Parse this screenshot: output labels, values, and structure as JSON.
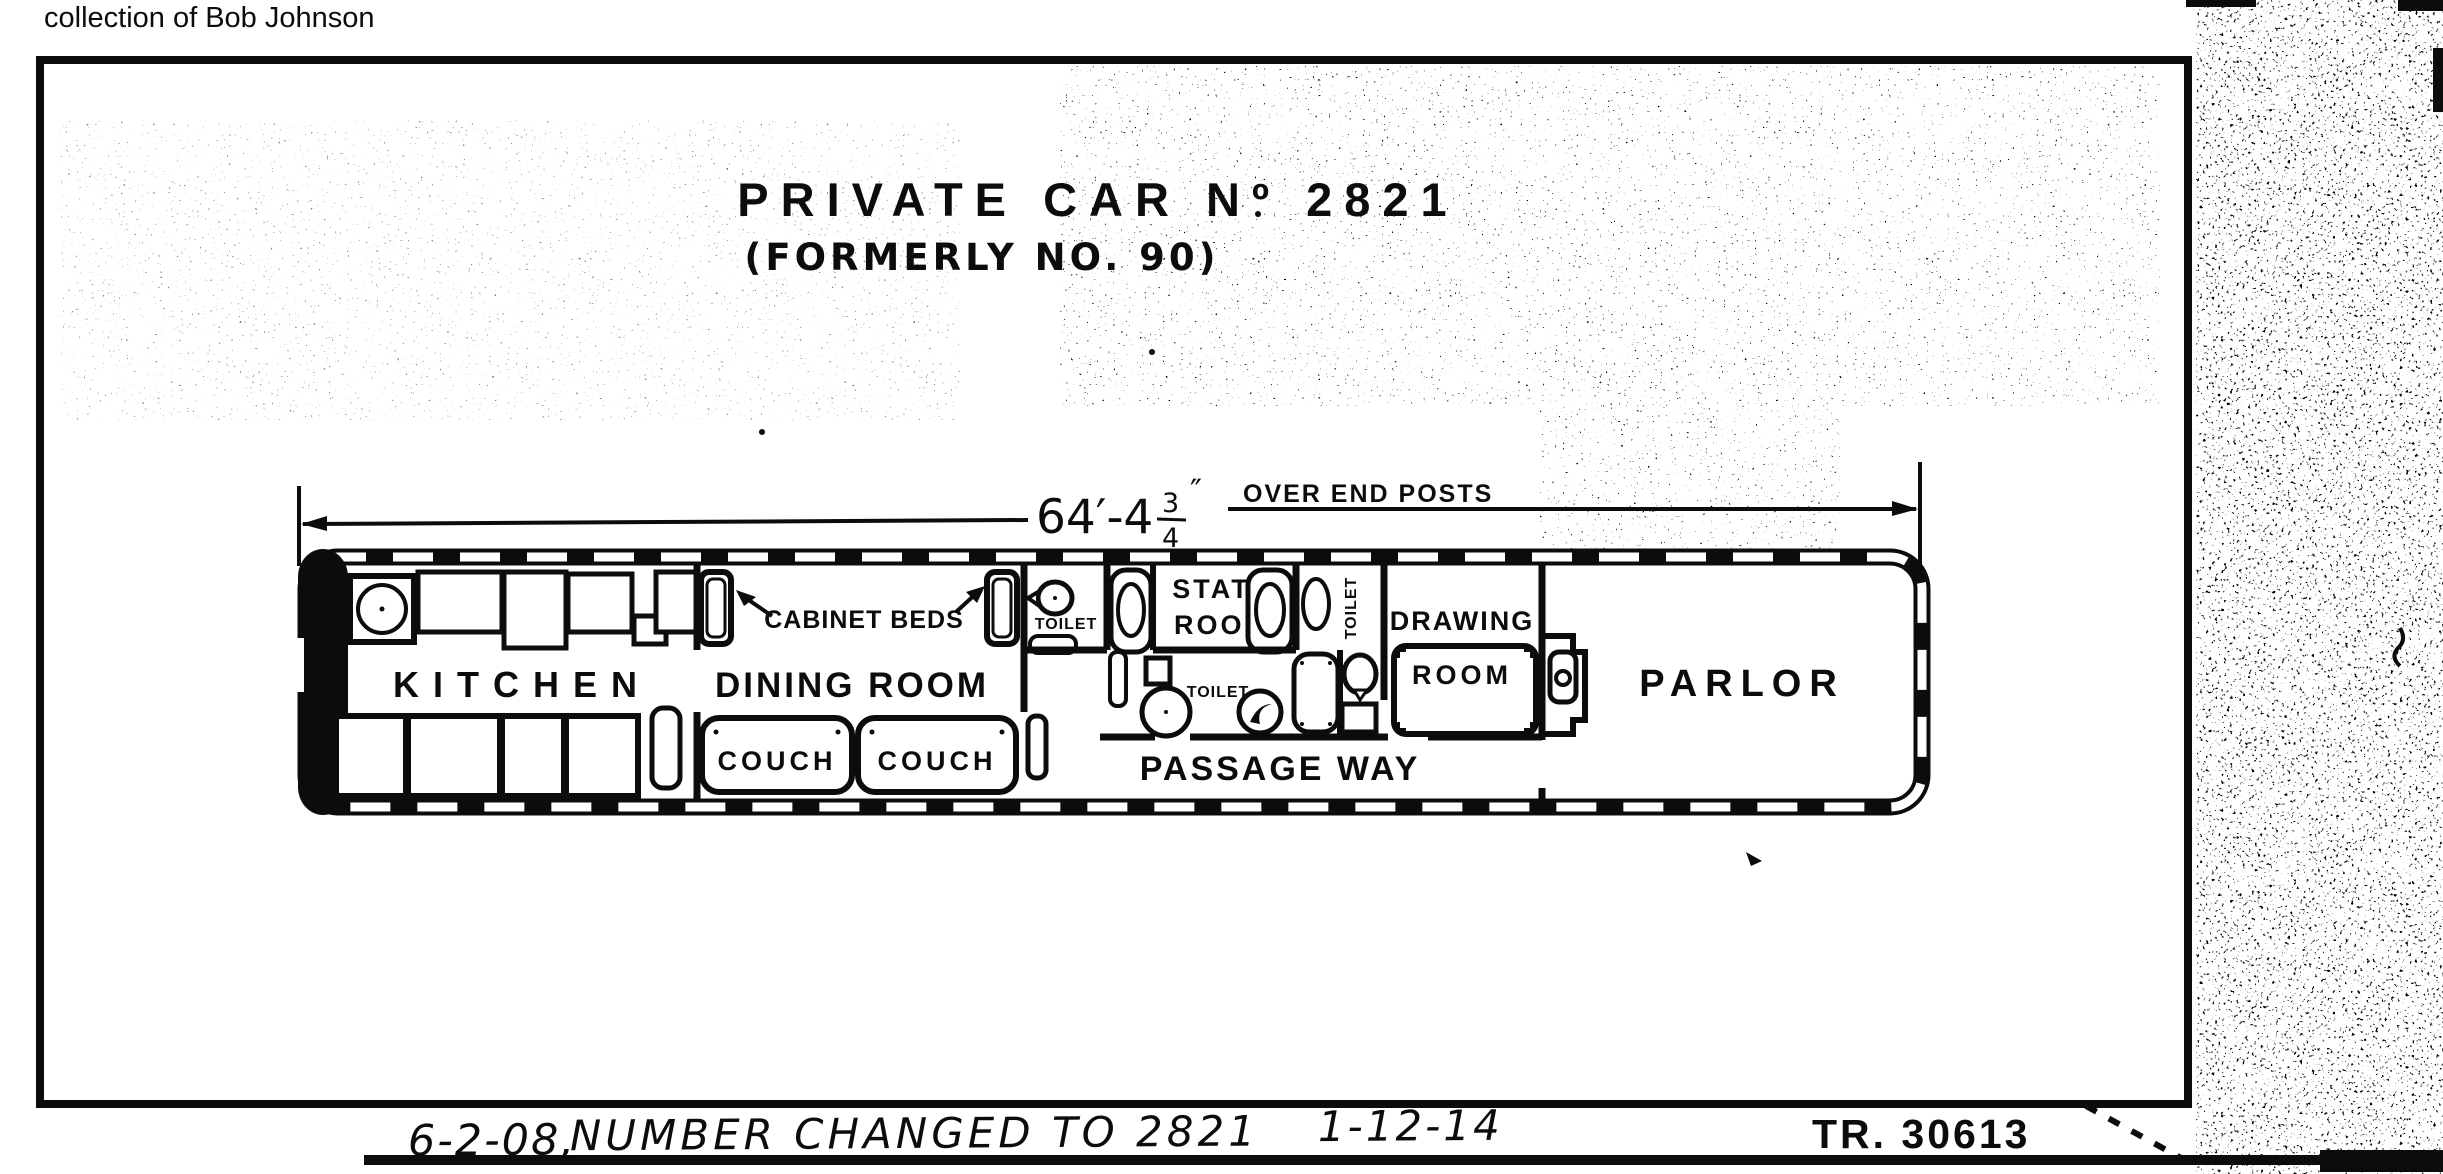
{
  "scan": {
    "collection_note": "collection of Bob Johnson",
    "drawing_number": "TR. 30613",
    "revision": {
      "date1": "6-2-08,",
      "text": "NUMBER CHANGED TO 2821",
      "date2": "1-12-14"
    }
  },
  "title": {
    "main": "PRIVATE CAR Nº 2821",
    "sub": "(FORMERLY NO. 90)"
  },
  "dimension": {
    "main": "64′-4",
    "frac_num": "3",
    "frac_den": "4",
    "inch_mark": "″",
    "note": "OVER END POSTS"
  },
  "rooms": {
    "kitchen": "KITCHEN",
    "dining_room": "DINING ROOM",
    "cabinet_beds": "CABINET BEDS",
    "couch_1": "COUCH",
    "couch_2": "COUCH",
    "toilet_upper": "TOILET",
    "toilet_mid": "TOILET",
    "toilet_side": "TOILET",
    "state_room_1": "STATE",
    "state_room_2": "ROOM",
    "drawing_room_1": "DRAWING",
    "drawing_room_2": "ROOM",
    "passage_way": "PASSAGE WAY",
    "parlor": "PARLOR"
  },
  "colors": {
    "ink": "#0c0c0c",
    "paper": "#ffffff"
  }
}
